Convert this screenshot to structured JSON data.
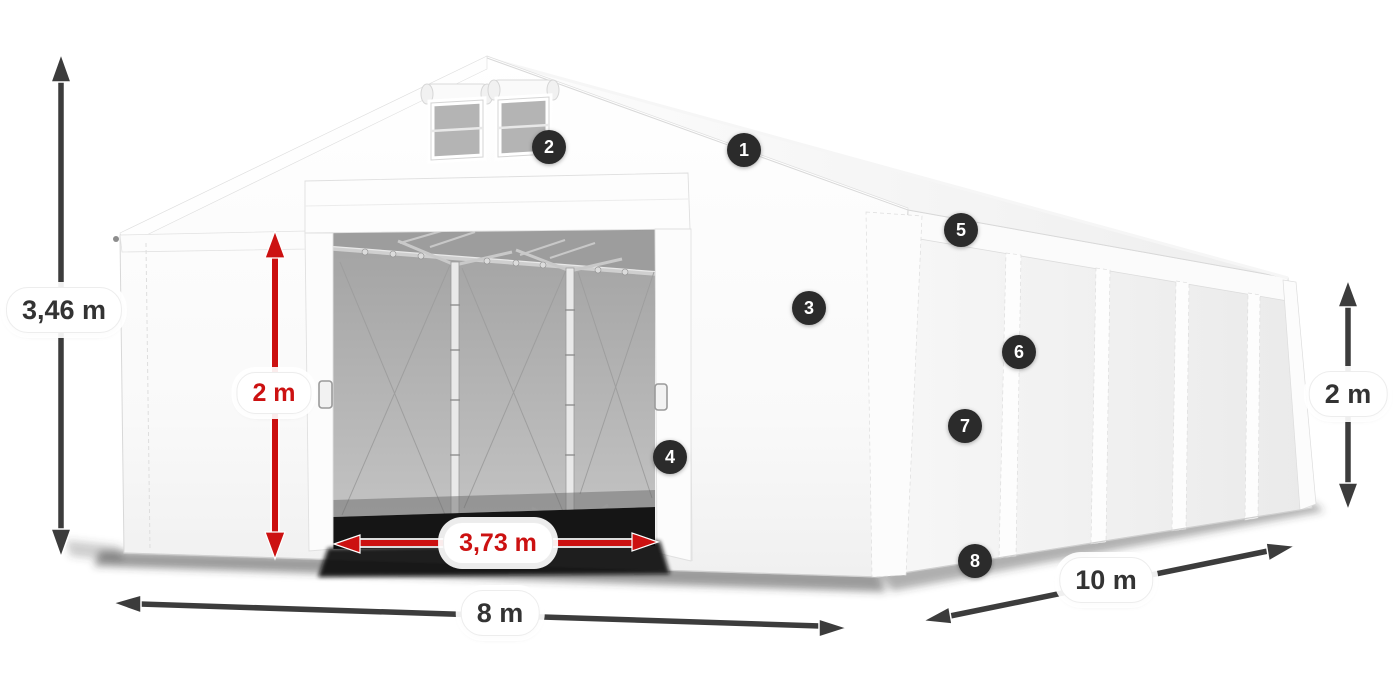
{
  "illustration": {
    "hotspots": [
      {
        "number": "1"
      },
      {
        "number": "2"
      },
      {
        "number": "3"
      },
      {
        "number": "4"
      },
      {
        "number": "5"
      },
      {
        "number": "6"
      },
      {
        "number": "7"
      },
      {
        "number": "8"
      }
    ],
    "dimensions": {
      "total_height": "3,46 m",
      "entrance_height": "2 m",
      "entrance_width": "3,73 m",
      "front_width": "8 m",
      "side_length": "10 m",
      "side_height": "2 m"
    },
    "colors": {
      "dimension_arrow_dark": "#3c3c3c",
      "dimension_arrow_red": "#cc1111",
      "hotspot_background": "#2b2b2b",
      "label_background": "#ffffff",
      "label_text_dark": "#333333",
      "tent_fabric": "#f7f7f7",
      "interior_gray": "#b3b3b3"
    }
  }
}
